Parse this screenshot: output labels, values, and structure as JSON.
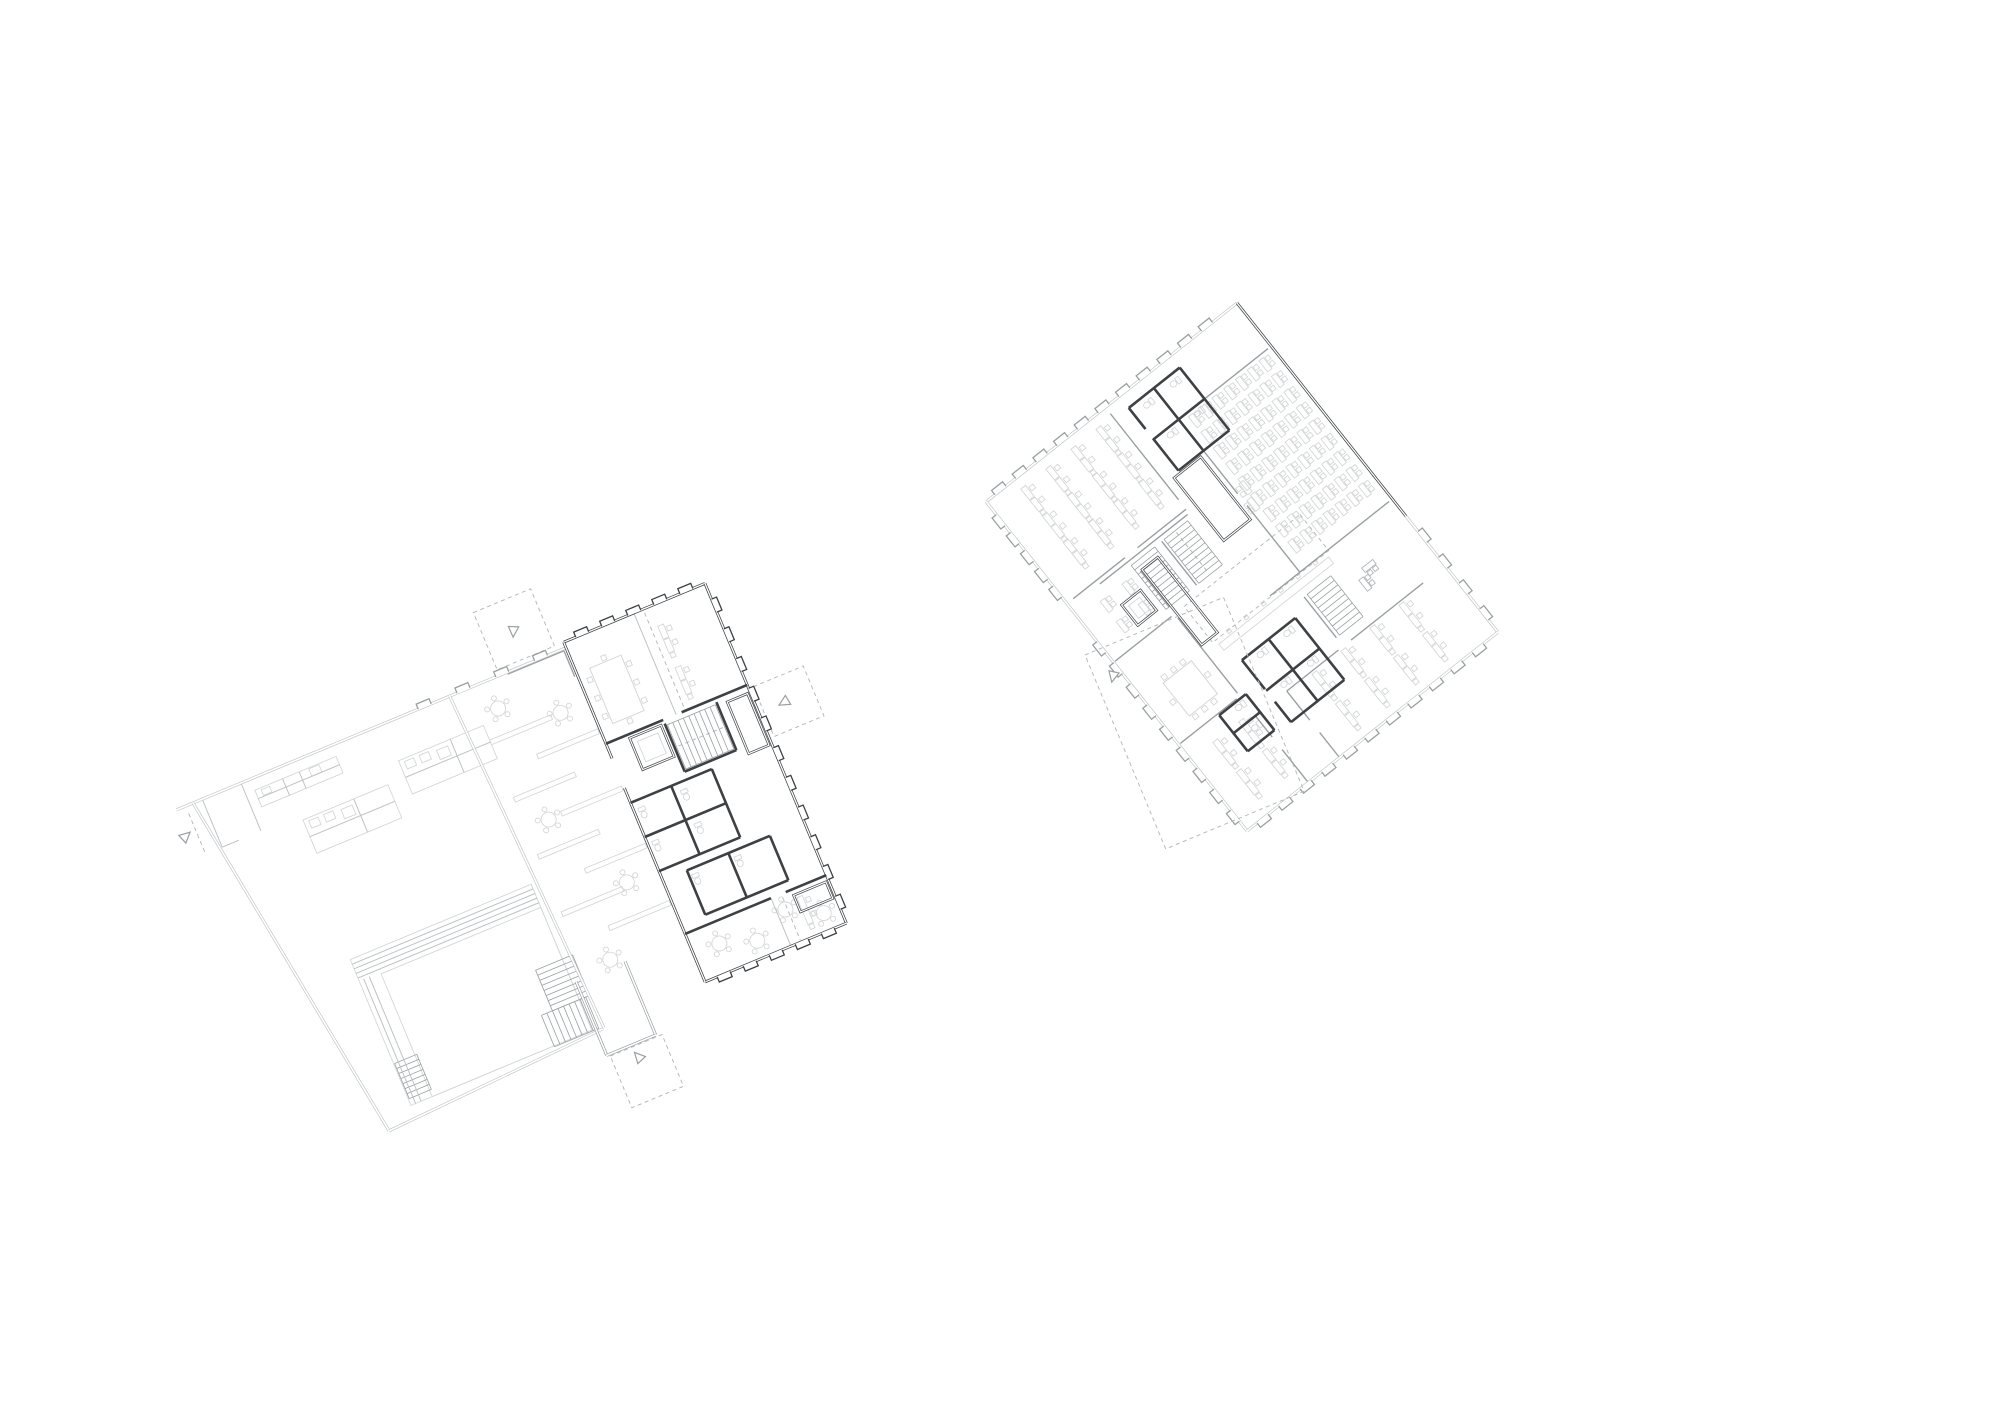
{
  "page": {
    "viewBox": "0 0 2000 1414",
    "width": 2000,
    "height": 1414,
    "background": "#ffffff"
  },
  "colors": {
    "dark": "#3d4144",
    "medium": "#9aa0a2",
    "light": "#bfc3c5",
    "furniture": "#d5d7d8",
    "furniture_medium": "#b2b6b8",
    "dashed": "#b7babc",
    "white": "#ffffff"
  },
  "drawing": {
    "type": "architectural floor plans",
    "plan_count": 2,
    "notes": "two rotated floor plans, line drawing, no text labels"
  },
  "plans": [
    {
      "id": "ground-floor-plan",
      "transform": "translate(193,803) rotate(-22.6)",
      "double_light": [
        [
          -18,
          0,
          278,
          0
        ],
        [
          278,
          0,
          404,
          0
        ],
        [
          0,
          0,
          55,
          378
        ],
        [
          55,
          378,
          292,
          366
        ],
        [
          278,
          0,
          293,
          366
        ]
      ],
      "double_medium": [
        [
          285,
          312,
          285,
          392
        ],
        [
          338,
          312,
          338,
          392
        ],
        [
          285,
          392,
          338,
          392
        ]
      ],
      "double_dark": [
        [
          404,
          -6,
          557,
          -6
        ],
        [
          557,
          -6,
          557,
          362
        ],
        [
          404,
          362,
          557,
          362
        ],
        [
          404,
          -6,
          404,
          120
        ],
        [
          404,
          152,
          404,
          362
        ]
      ],
      "solid_light": [
        [
          10,
          0,
          10,
          52
        ],
        [
          52,
          0,
          52,
          52
        ],
        [
          10,
          52,
          28,
          52
        ],
        [
          480,
          -6,
          480,
          104
        ],
        [
          497,
          310,
          497,
          362
        ],
        [
          85,
          210,
          281,
          210
        ],
        [
          85,
          215,
          281,
          215
        ],
        [
          85,
          220,
          281,
          220
        ],
        [
          85,
          225,
          281,
          225
        ],
        [
          90,
          228,
          90,
          363
        ],
        [
          96,
          228,
          96,
          363
        ],
        [
          62,
          21,
          150,
          21
        ],
        [
          92,
          12,
          92,
          30
        ],
        [
          110,
          12,
          110,
          30
        ],
        [
          95,
          76,
          187,
          76
        ],
        [
          150,
          58,
          150,
          94
        ],
        [
          206,
          58,
          298,
          58
        ],
        [
          262,
          40,
          262,
          76
        ]
      ],
      "solid_medium": [
        [
          340,
          2,
          401,
          2
        ],
        [
          401,
          2,
          401,
          30
        ]
      ],
      "solid_dark": [
        [
          404,
          104,
          466,
          104
        ],
        [
          486,
          104,
          557,
          104
        ],
        [
          466,
          108,
          466,
          160
        ],
        [
          522,
          108,
          522,
          160
        ],
        [
          466,
          160,
          522,
          160
        ],
        [
          404,
          168,
          492,
          168
        ],
        [
          492,
          168,
          492,
          242
        ],
        [
          404,
          242,
          492,
          242
        ],
        [
          448,
          168,
          448,
          242
        ],
        [
          404,
          205,
          492,
          205
        ],
        [
          430,
          252,
          520,
          252
        ],
        [
          430,
          252,
          430,
          300
        ],
        [
          520,
          252,
          520,
          300
        ],
        [
          430,
          300,
          520,
          300
        ],
        [
          475,
          252,
          475,
          300
        ],
        [
          404,
          310,
          497,
          310
        ],
        [
          513,
          310,
          557,
          310
        ]
      ],
      "rects_light": [
        [
          85,
          205,
          196,
          158
        ],
        [
          108,
          230,
          173,
          133
        ],
        [
          62,
          12,
          88,
          18
        ],
        [
          95,
          58,
          92,
          36
        ],
        [
          206,
          40,
          92,
          36
        ],
        [
          68,
          14,
          9,
          6
        ],
        [
          120,
          13,
          11,
          8
        ],
        [
          100,
          61,
          10,
          8
        ],
        [
          116,
          61,
          10,
          8
        ],
        [
          134,
          63,
          12,
          10
        ],
        [
          211,
          43,
          10,
          8
        ],
        [
          227,
          43,
          10,
          8
        ],
        [
          245,
          45,
          12,
          10
        ],
        [
          298,
          56,
          66,
          5
        ],
        [
          298,
          118,
          66,
          5
        ],
        [
          298,
          180,
          66,
          5
        ],
        [
          298,
          242,
          66,
          5
        ],
        [
          336,
          87,
          66,
          5
        ],
        [
          336,
          149,
          66,
          5
        ],
        [
          336,
          211,
          66,
          5
        ],
        [
          336,
          273,
          66,
          5
        ],
        [
          434,
          114,
          22,
          22
        ]
      ],
      "rects_dark_double": [
        [
          428,
          108,
          34,
          34
        ],
        [
          532,
          112,
          22,
          56
        ],
        [
          519,
          316,
          35,
          18
        ]
      ],
      "dashed_rects": [
        [
          332,
          -68,
          62,
          62
        ],
        [
          562,
          108,
          54,
          54
        ],
        [
          288,
          394,
          56,
          56
        ]
      ],
      "dashed_lines": [
        [
          -8,
          8,
          -8,
          50
        ],
        [
          490,
          -2,
          490,
          100
        ],
        [
          470,
          134,
          518,
          134
        ],
        [
          508,
          314,
          508,
          360
        ]
      ],
      "stairs": [
        {
          "x": 252,
          "y": 286,
          "w": 40,
          "h": 44,
          "n": 8,
          "dir": "y"
        },
        {
          "x": 86,
          "y": 318,
          "w": 24,
          "h": 38,
          "n": 7,
          "dir": "y"
        },
        {
          "x": 240,
          "y": 330,
          "w": 48,
          "h": 34,
          "n": 8,
          "dir": "x"
        },
        {
          "x": 468,
          "y": 110,
          "w": 52,
          "h": 48,
          "n": 9,
          "dir": "x"
        }
      ],
      "round_tables": [
        [
          318,
          30
        ],
        [
          374,
          58
        ],
        [
          322,
          152
        ],
        [
          370,
          240
        ],
        [
          325,
          305
        ],
        [
          432,
          332
        ],
        [
          468,
          344
        ],
        [
          506,
          326
        ],
        [
          540,
          344
        ]
      ],
      "desk_pairs": [
        [
          500,
          30,
          90
        ],
        [
          500,
          75,
          90
        ],
        [
          524,
          334,
          90
        ]
      ],
      "desks": [],
      "desks_medium": [],
      "desk_grids": [],
      "conference_tables": [
        {
          "x": 418,
          "y": 28,
          "w": 34,
          "h": 60
        }
      ],
      "toilets": [
        [
          412,
          176
        ],
        [
          458,
          176
        ],
        [
          412,
          212
        ],
        [
          458,
          212
        ],
        [
          436,
          258
        ],
        [
          482,
          258
        ]
      ],
      "windows_dark": [
        {
          "run": [
            410,
            -6,
            551,
            -6
          ],
          "n": 5,
          "rot": 0
        },
        {
          "run": [
            557,
            2,
            557,
            356
          ],
          "n": 11,
          "rot": 90
        },
        {
          "run": [
            410,
            362,
            551,
            362
          ],
          "n": 5,
          "rot": 180
        }
      ],
      "windows_medium": [
        {
          "run": [
            230,
            0,
            398,
            0
          ],
          "n": 4,
          "rot": 0
        }
      ],
      "arrows": [
        {
          "x": 362,
          "y": -36,
          "rot": 205
        },
        {
          "x": 585,
          "y": 134,
          "rot": 262
        },
        {
          "x": 314,
          "y": 406,
          "rot": 340
        },
        {
          "x": -20,
          "y": 28,
          "rot": 70
        }
      ]
    },
    {
      "id": "upper-floor-plan",
      "transform": "translate(1237,303) rotate(51.6)",
      "double_light": [
        [
          272,
          0,
          420,
          0
        ],
        [
          0,
          0,
          0,
          320
        ],
        [
          0,
          320,
          420,
          320
        ],
        [
          420,
          0,
          420,
          320
        ]
      ],
      "double_medium": [],
      "double_dark": [
        [
          0,
          0,
          272,
          0
        ]
      ],
      "solid_light": [],
      "solid_medium": [
        [
          55,
          4,
          55,
          118
        ],
        [
          55,
          118,
          150,
          118
        ],
        [
          165,
          118,
          250,
          118
        ],
        [
          250,
          4,
          250,
          118
        ],
        [
          8,
          168,
          118,
          168
        ],
        [
          130,
          168,
          130,
          230
        ],
        [
          130,
          246,
          130,
          312
        ],
        [
          135,
          170,
          135,
          282
        ],
        [
          335,
          28,
          335,
          120
        ],
        [
          335,
          136,
          335,
          202
        ],
        [
          335,
          202,
          372,
          202
        ],
        [
          388,
          202,
          420,
          202
        ],
        [
          150,
          242,
          196,
          242
        ],
        [
          210,
          242,
          306,
          242
        ],
        [
          205,
          246,
          205,
          318
        ],
        [
          310,
          246,
          310,
          318
        ],
        [
          336,
          242,
          362,
          242
        ],
        [
          378,
          242,
          420,
          242
        ],
        [
          140,
          207,
          196,
          207
        ],
        [
          272,
          130,
          324,
          130
        ],
        [
          250,
          118,
          250,
          156
        ]
      ],
      "solid_dark": [
        [
          15,
          85,
          95,
          85
        ],
        [
          15,
          85,
          15,
          150
        ],
        [
          95,
          85,
          95,
          150
        ],
        [
          55,
          85,
          55,
          150
        ],
        [
          15,
          118,
          95,
          118
        ],
        [
          15,
          150,
          42,
          150
        ],
        [
          54,
          150,
          95,
          150
        ],
        [
          283,
          150,
          362,
          150
        ],
        [
          283,
          150,
          283,
          218
        ],
        [
          362,
          150,
          362,
          218
        ],
        [
          322,
          150,
          322,
          218
        ],
        [
          283,
          184,
          362,
          184
        ],
        [
          283,
          218,
          320,
          218
        ],
        [
          336,
          218,
          362,
          218
        ],
        [
          312,
          236,
          358,
          236
        ],
        [
          312,
          236,
          312,
          270
        ],
        [
          358,
          236,
          358,
          270
        ],
        [
          312,
          270,
          358,
          270
        ],
        [
          335,
          236,
          335,
          270
        ]
      ],
      "rects_light": [
        [
          170,
          259,
          16,
          14
        ],
        [
          250,
          98,
          4,
          4
        ],
        [
          250,
          120,
          4,
          4
        ],
        [
          250,
          142,
          4,
          4
        ],
        [
          250,
          164,
          4,
          4
        ],
        [
          250,
          186,
          4,
          4
        ],
        [
          250,
          208,
          4,
          4
        ],
        [
          256,
          86,
          8,
          140
        ]
      ],
      "rects_dark_double": [
        [
          98,
          124,
          80,
          34
        ],
        [
          150,
          220,
          96,
          20
        ],
        [
          165,
          254,
          26,
          24
        ]
      ],
      "dashed_rects": [
        [
          205,
          82,
          46,
          148
        ]
      ],
      "dashed_lines": [
        [
          142,
          190,
          194,
          190
        ]
      ],
      "stairs": [
        {
          "x": 140,
          "y": 174,
          "w": 56,
          "h": 30,
          "n": 10,
          "dir": "x"
        },
        {
          "x": 140,
          "y": 216,
          "w": 56,
          "h": 30,
          "n": 10,
          "dir": "x"
        },
        {
          "x": 272,
          "y": 96,
          "w": 52,
          "h": 30,
          "n": 9,
          "dir": "x"
        }
      ],
      "round_tables": [],
      "desk_pairs": [],
      "desks": [
        [
          150,
          108,
          180
        ],
        [
          168,
          112,
          180
        ]
      ],
      "desks_medium": [
        [
          288,
          60,
          90
        ],
        [
          300,
          74,
          0
        ]
      ],
      "desk_grids": [
        {
          "x0": 66,
          "y0": 16,
          "cols": 9,
          "rows": 7,
          "dx": 20,
          "dy": 15,
          "type": "desk"
        },
        {
          "x0": 26,
          "y0": 186,
          "cols": 3,
          "rows": 4,
          "dx": 34,
          "dy": 32,
          "type": "pair"
        },
        {
          "x0": 352,
          "y0": 58,
          "cols": 2,
          "rows": 4,
          "dx": 38,
          "dy": 37,
          "type": "pair"
        },
        {
          "x0": 344,
          "y0": 256,
          "cols": 2,
          "rows": 2,
          "dx": 38,
          "dy": 33,
          "type": "pair"
        },
        {
          "x0": 156,
          "y0": 262,
          "cols": 2,
          "rows": 2,
          "dx": 26,
          "dy": 28,
          "type": "desk"
        }
      ],
      "conference_tables": [
        {
          "x": 252,
          "y": 258,
          "w": 42,
          "h": 36
        }
      ],
      "toilets": [
        [
          24,
          92
        ],
        [
          62,
          92
        ],
        [
          24,
          126
        ],
        [
          62,
          126
        ],
        [
          290,
          158
        ],
        [
          328,
          158
        ],
        [
          290,
          192
        ],
        [
          328,
          192
        ],
        [
          318,
          242
        ],
        [
          344,
          242
        ]
      ],
      "windows_dark": [],
      "windows_medium": [
        {
          "run": [
            282,
            0,
            414,
            0
          ],
          "n": 4,
          "rot": 0
        },
        {
          "run": [
            0,
            25,
            0,
            315
          ],
          "n": 11,
          "rot": 270
        },
        {
          "run": [
            12,
            320,
            126,
            320
          ],
          "n": 5,
          "rot": 180
        },
        {
          "run": [
            172,
            320,
            414,
            320
          ],
          "n": 9,
          "rot": 180
        },
        {
          "run": [
            420,
            12,
            420,
            314
          ],
          "n": 11,
          "rot": 90
        }
      ],
      "arrows": []
    },
    {
      "id": "adjacent-footprint-reference",
      "transform": "translate(1085,655) rotate(-22.6)",
      "double_light": [],
      "double_medium": [],
      "double_dark": [],
      "solid_light": [],
      "solid_medium": [],
      "solid_dark": [],
      "rects_light": [],
      "rects_dark_double": [],
      "dashed_rects": [
        [
          0,
          0,
          150,
          210
        ]
      ],
      "dashed_lines": [],
      "stairs": [],
      "round_tables": [],
      "desk_pairs": [],
      "desks": [],
      "desks_medium": [],
      "desk_grids": [],
      "conference_tables": [],
      "toilets": [],
      "windows_dark": [],
      "windows_medium": [],
      "arrows": [
        {
          "x": 18,
          "y": 30,
          "rot": 215
        }
      ]
    }
  ]
}
